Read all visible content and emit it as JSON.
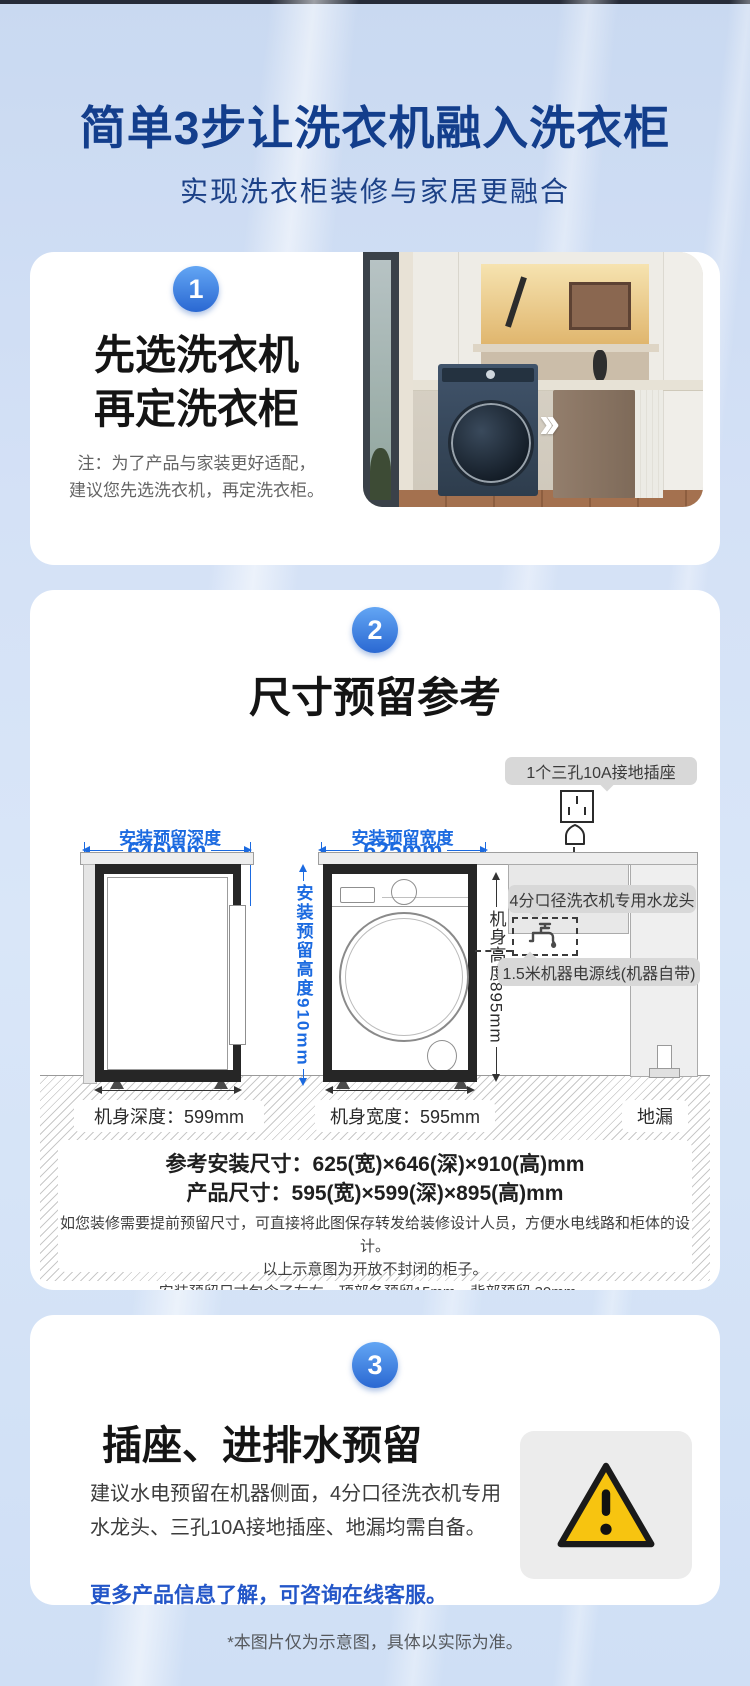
{
  "page": {
    "title": "简单3步让洗衣机融入洗衣柜",
    "subtitle": "实现洗衣柜装修与家居更融合",
    "footnote": "*本图片仅为示意图，具体以实际为准。",
    "colors": {
      "title_blue": "#133e8c",
      "accent_blue": "#2a68d2",
      "dim_blue": "#1b6ae0",
      "bubble_gray": "#d8d8d8",
      "warning_yellow": "#f7c410"
    }
  },
  "step1": {
    "badge": "1",
    "heading_line1": "先选洗衣机",
    "heading_line2": "再定洗衣柜",
    "note_line1": "注：为了产品与家装更好适配，",
    "note_line2": "建议您先选洗衣机，再定洗衣柜。",
    "photo_chevrons": "››"
  },
  "step2": {
    "badge": "2",
    "title": "尺寸预留参考",
    "callouts": {
      "socket": "1个三孔10A接地插座",
      "faucet": "4分口径洗衣机专用水龙头",
      "power": "1.5米机器电源线(机器自带)"
    },
    "dims": {
      "depth_label": "安装预留深度",
      "depth_value": "646mm",
      "width_label": "安装预留宽度",
      "width_value": "625mm",
      "height_label": "安装预留高度910mm",
      "body_height_label": "机身高度895mm",
      "body_depth_label": "机身深度：599mm",
      "body_width_label": "机身宽度：595mm",
      "drain_label": "地漏"
    },
    "summary": {
      "line1": "参考安装尺寸：625(宽)×646(深)×910(高)mm",
      "line2": "产品尺寸：595(宽)×599(深)×895(高)mm",
      "note1": "如您装修需要提前预留尺寸，可直接将此图保存转发给装修设计人员，方便水电线路和柜体的设计。",
      "note2": "以上示意图为开放不封闭的柜子。",
      "note3": "安装预留尺寸包含了左右、顶部各预留15mm，背部预留 30mm。"
    }
  },
  "step3": {
    "badge": "3",
    "title": "插座、进排水预留",
    "body": "建议水电预留在机器侧面，4分口径洗衣机专用水龙头、三孔10A接地插座、地漏均需自备。",
    "highlight": "更多产品信息了解，可咨询在线客服。"
  }
}
